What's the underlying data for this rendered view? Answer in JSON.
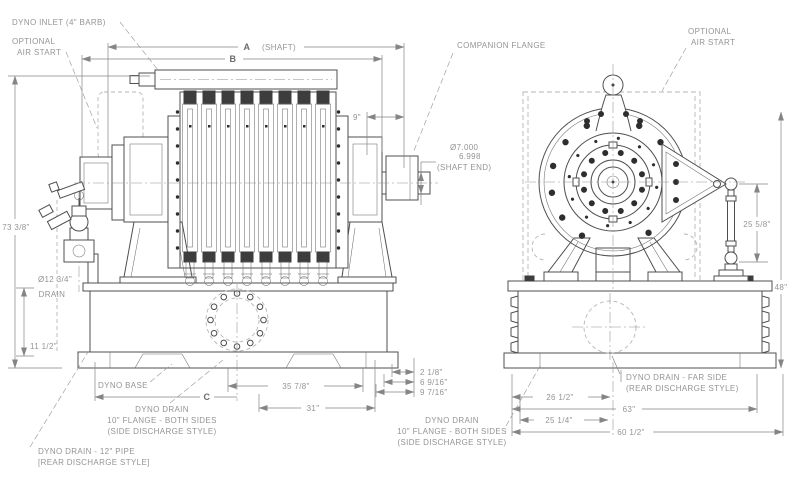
{
  "colors": {
    "line": "#4f4f4f",
    "text": "#949494",
    "ghost_dashed": "#b6b6b6",
    "bolt_dark": "#2e2e2e",
    "background": "#ffffff"
  },
  "lv": {
    "dyno_inlet": "DYNO INLET (4\" BARB)",
    "opt_air_1": "OPTIONAL",
    "opt_air_2": "AIR START",
    "dim_a": "A",
    "dim_a_note": "(SHAFT)",
    "dim_b": "B",
    "dim_9": "9\"",
    "companion_flange": "COMPANION FLANGE",
    "shaft_dia_hi": "Ø7.000",
    "shaft_dia_lo": "6.998",
    "shaft_end": "(SHAFT END)",
    "overall_height": "73 3/8\"",
    "drain_dia_1": "Ø12 3/4\"",
    "drain_dia_2": "DRAIN",
    "base_height": "11 1/2\"",
    "dyno_base": "DYNO BASE",
    "dim_c": "C",
    "dim_35_78": "35 7/8\"",
    "dim_31": "31\"",
    "dim_2_18": "2 1/8\"",
    "dim_6_916": "6 9/16\"",
    "dim_9_716": "9 7/16\"",
    "drain_flange_1": "DYNO DRAIN",
    "drain_flange_2": "10\" FLANGE - BOTH SIDES",
    "drain_flange_3": "(SIDE DISCHARGE STYLE)",
    "drain_pipe_1": "DYNO DRAIN - 12\" PIPE",
    "drain_pipe_2": "[REAR DISCHARGE STYLE]"
  },
  "rv": {
    "opt_air_1": "OPTIONAL",
    "opt_air_2": "AIR START",
    "link_len": "25 5/8\"",
    "overall_48": "48\"",
    "drain_far_1": "DYNO DRAIN - FAR SIDE",
    "drain_far_2": "(REAR DISCHARGE STYLE)",
    "dim_26_12": "26 1/2\"",
    "dim_63": "63\"",
    "dim_25_14": "25 1/4\"",
    "dim_60_12": "60 1/2\"",
    "drain_flange_1": "DYNO DRAIN",
    "drain_flange_2": "10\" FLANGE - BOTH SIDES",
    "drain_flange_3": "(SIDE DISCHARGE STYLE)"
  }
}
